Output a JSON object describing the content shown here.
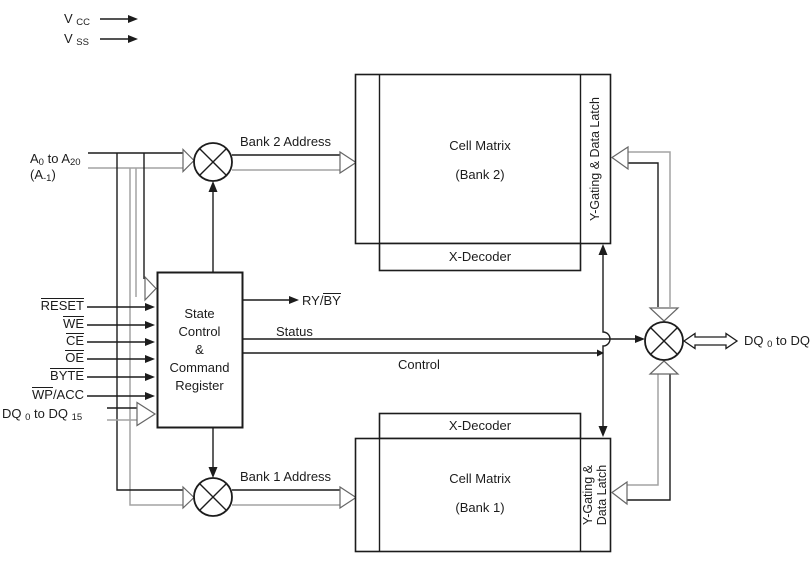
{
  "diagram": {
    "title_hint": "flash-memory-block-diagram",
    "colors": {
      "line": "#1c1c1c",
      "bus_gray": "#a3a3a3",
      "background": "#ffffff"
    },
    "power_inputs": {
      "vcc": [
        {
          "t": "V "
        },
        {
          "t": "CC",
          "sub": true
        }
      ],
      "vss": [
        {
          "t": "V "
        },
        {
          "t": "SS",
          "sub": true
        }
      ]
    },
    "address_input": {
      "line1": [
        {
          "t": "A"
        },
        {
          "t": "0",
          "sub": true
        },
        {
          "t": " to A"
        },
        {
          "t": "20",
          "sub": true
        }
      ],
      "line2": [
        {
          "t": "(A"
        },
        {
          "t": "-1",
          "sub": true
        },
        {
          "t": ")"
        }
      ]
    },
    "control_inputs": {
      "reset": [
        {
          "t": "RESET",
          "over": true
        }
      ],
      "we": [
        {
          "t": "WE",
          "over": true
        }
      ],
      "ce": [
        {
          "t": "CE",
          "over": true
        }
      ],
      "oe": [
        {
          "t": "OE",
          "over": true
        }
      ],
      "byte": [
        {
          "t": "BYTE",
          "over": true
        }
      ],
      "wp_acc": [
        {
          "t": "WP",
          "over": true
        },
        {
          "t": "/ACC"
        }
      ],
      "dq_in": [
        {
          "t": "DQ "
        },
        {
          "t": "0",
          "sub": true
        },
        {
          "t": " to DQ "
        },
        {
          "t": "15",
          "sub": true
        }
      ]
    },
    "state_register": {
      "lines": [
        "State",
        "Control",
        "&",
        "Command",
        "Register"
      ]
    },
    "outputs": {
      "ry_by": [
        {
          "t": "RY/"
        },
        {
          "t": "BY",
          "over": true
        }
      ],
      "status": "Status",
      "control": "Control",
      "dq_out": [
        {
          "t": "DQ "
        },
        {
          "t": "0",
          "sub": true
        },
        {
          "t": " to DQ "
        },
        {
          "t": "15",
          "sub": true
        }
      ]
    },
    "bank2": {
      "address_label": "Bank 2 Address",
      "cell_matrix": "Cell Matrix",
      "bank_label": "(Bank 2)",
      "x_decoder": "X-Decoder",
      "y_gating": "Y-Gating & Data Latch"
    },
    "bank1": {
      "address_label": "Bank 1 Address",
      "cell_matrix": "Cell Matrix",
      "bank_label": "(Bank 1)",
      "x_decoder": "X-Decoder",
      "y_gating_line1": "Y-Gating &",
      "y_gating_line2": "Data Latch"
    }
  }
}
